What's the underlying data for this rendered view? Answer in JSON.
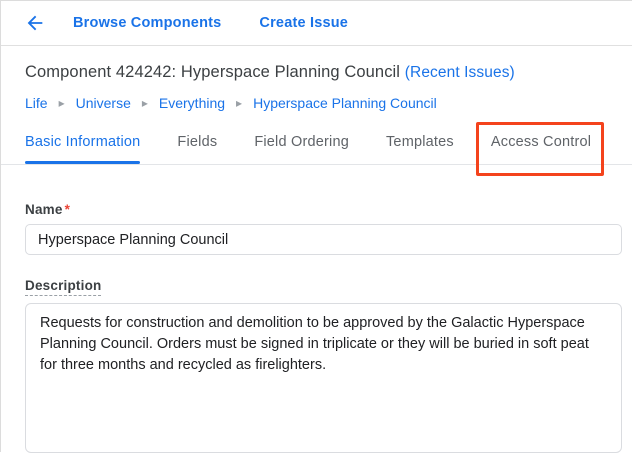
{
  "colors": {
    "link_blue": "#1a73e8",
    "text_dark": "#3c4043",
    "tab_inactive_gray": "#5f6368",
    "divider_gray": "#e0e0e0",
    "input_border": "#dadce0",
    "required_red": "#ea4335",
    "annotation_red": "#f4431c"
  },
  "topbar": {
    "back_icon": "arrow-back",
    "browse_components_label": "Browse Components",
    "create_issue_label": "Create Issue"
  },
  "header": {
    "title": "Component 424242: Hyperspace Planning Council",
    "recent_issues_label": "(Recent Issues)"
  },
  "breadcrumb": {
    "separator": "▸",
    "items": [
      "Life",
      "Universe",
      "Everything",
      "Hyperspace Planning Council"
    ]
  },
  "tabs": {
    "items": [
      {
        "label": "Basic Information",
        "active": true,
        "highlighted": false
      },
      {
        "label": "Fields",
        "active": false,
        "highlighted": false
      },
      {
        "label": "Field Ordering",
        "active": false,
        "highlighted": false
      },
      {
        "label": "Templates",
        "active": false,
        "highlighted": false
      },
      {
        "label": "Access Control",
        "active": false,
        "highlighted": true
      }
    ]
  },
  "form": {
    "name_label": "Name",
    "required_marker": "*",
    "name_value": "Hyperspace Planning Council",
    "description_label": "Description",
    "description_value": "Requests for construction and demolition to be approved by the Galactic Hyperspace Planning Council. Orders must be signed in triplicate or they will be buried in soft peat for three months and recycled as firelighters."
  }
}
